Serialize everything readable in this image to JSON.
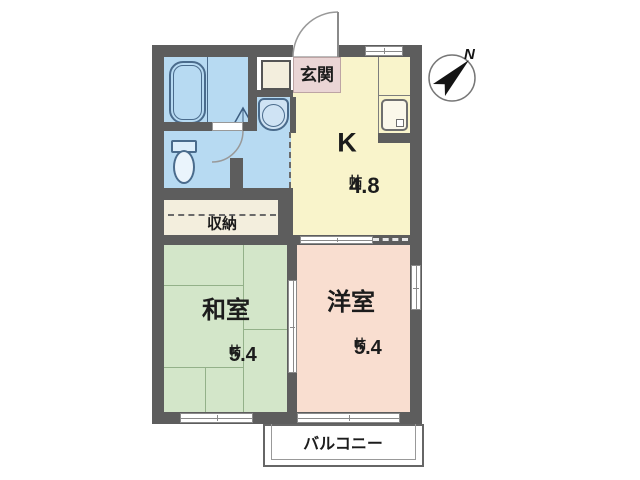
{
  "compass": {
    "label": "N"
  },
  "rooms": {
    "genkan": {
      "label": "玄関"
    },
    "kitchen": {
      "label": "K",
      "size": "4.8",
      "unit": "帖"
    },
    "storage": {
      "label": "収納"
    },
    "japanese": {
      "label": "和室",
      "size": "5.4",
      "unit": "帖"
    },
    "western": {
      "label": "洋室",
      "size": "5.4",
      "unit": "帖"
    },
    "balcony": {
      "label": "バルコニー"
    }
  },
  "fixtures": [
    "bathtub",
    "toilet",
    "washbasin",
    "kitchen-sink",
    "shoe-cabinet",
    "entrance-door",
    "bathroom-door"
  ],
  "colors": {
    "wall": "#5d5d5d",
    "kitchen_floor": "#f9f4cb",
    "storage_floor": "#f3eedd",
    "tatami_floor": "#d3e6c9",
    "western_floor": "#f9ded0",
    "wet_floor": "#b7daf2",
    "genkan_floor": "#ead5d5",
    "fixture": "#4a6b8c",
    "tatami_line": "#93b189"
  }
}
